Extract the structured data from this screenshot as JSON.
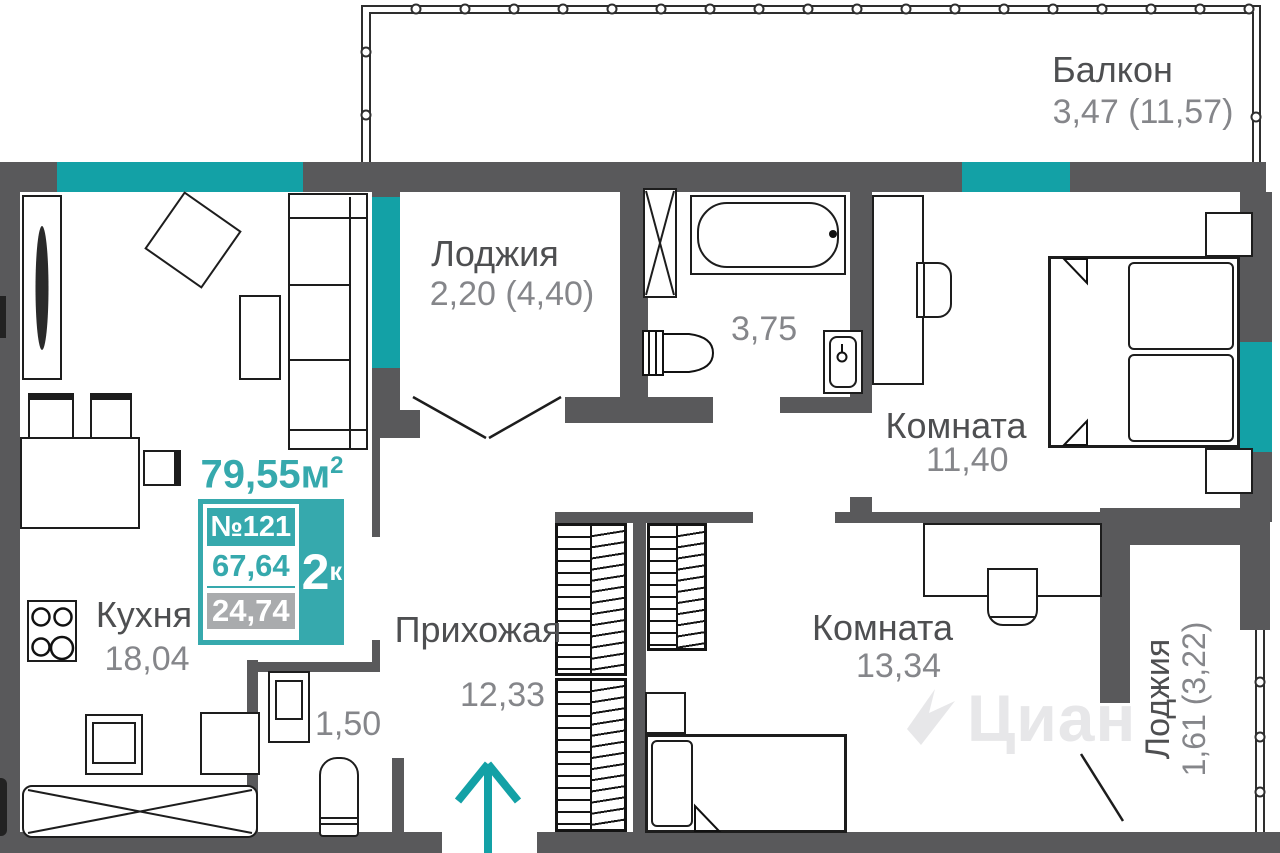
{
  "colors": {
    "wall": "#59595b",
    "window_teal": "#13a1a6",
    "accent_teal": "#36a9ad",
    "label": "#4e4f51",
    "number": "#85868a",
    "badge_gray": "#a9abad"
  },
  "info_card": {
    "total_area_value": "79,55",
    "total_area_unit": "м",
    "total_area_sup": "2",
    "apartment_number": "№121",
    "rooms_count": "2",
    "rooms_suffix": "к",
    "living_area": "67,64",
    "kitchen_area": "24,74"
  },
  "rooms": {
    "balcony": {
      "label": "Балкон",
      "area": "3,47 (11,57)"
    },
    "loggia_top": {
      "label": "Лоджия",
      "area": "2,20 (4,40)"
    },
    "bathroom": {
      "area": "3,75"
    },
    "bedroom": {
      "label": "Комната",
      "area": "11,40"
    },
    "kitchen": {
      "label": "Кухня",
      "area": "18,04"
    },
    "hallway": {
      "label": "Прихожая",
      "area": "12,33"
    },
    "storage": {
      "area": "1,50"
    },
    "room2": {
      "label": "Комната",
      "area": "13,34"
    },
    "loggia_right": {
      "label": "Лоджия",
      "area": "1,61 (3,22)"
    }
  },
  "watermark": {
    "text": "Циан"
  }
}
